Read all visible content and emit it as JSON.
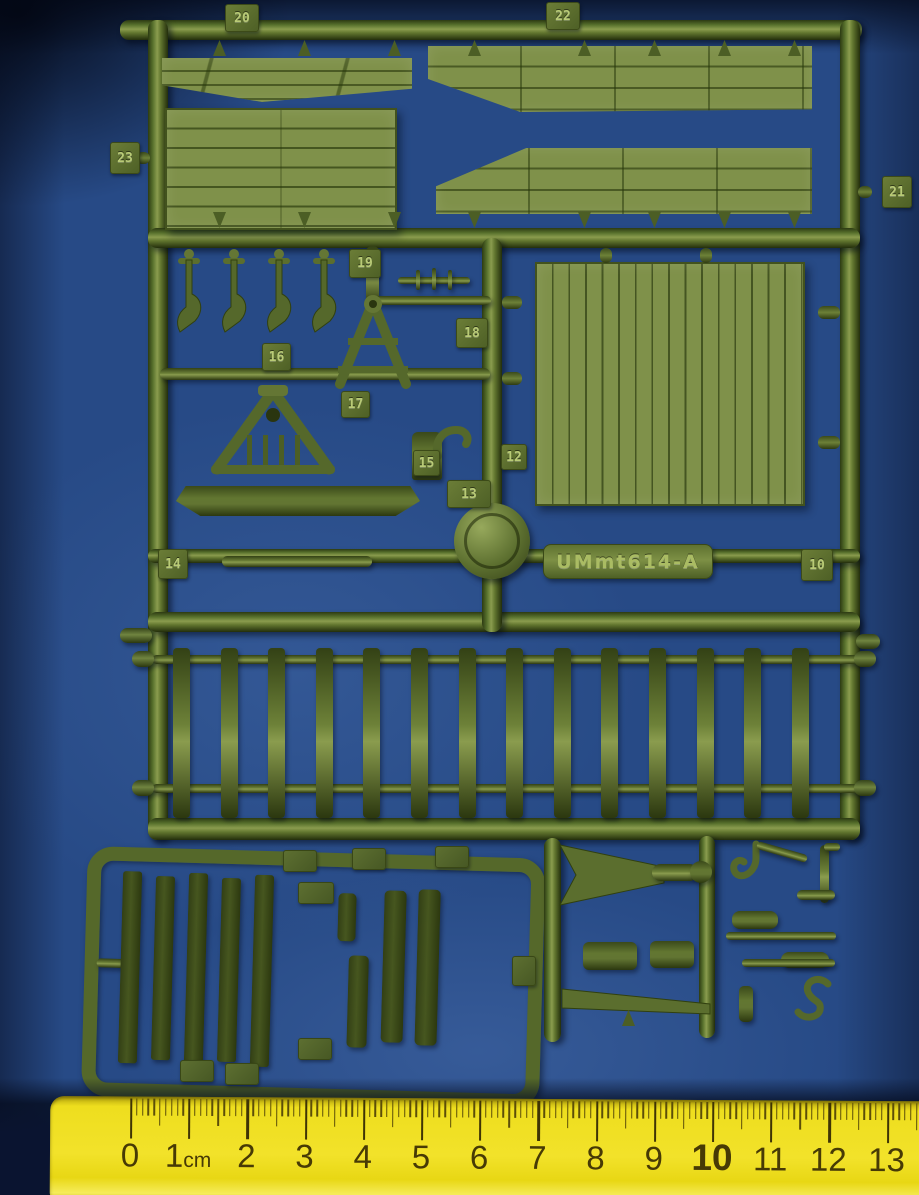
{
  "colors": {
    "background_blue": "#274a86",
    "sprue_olive": "#55682b",
    "panel_olive": "#7f914a",
    "dark_part_olive": "#3d4c1d",
    "ruler_yellow": "#eede1e",
    "ruler_markings": "#473a05"
  },
  "sprue": {
    "mold_plate": "UMmt614-A",
    "part_labels": [
      "20",
      "22",
      "23",
      "21",
      "19",
      "18",
      "16",
      "17",
      "15",
      "12",
      "13",
      "14",
      "10"
    ],
    "stakes_count": 14,
    "hooks_count": 4,
    "strips_count": 5
  },
  "ruler": {
    "unit": "cm",
    "labels": [
      "0",
      "1cm",
      "2",
      "3",
      "4",
      "5",
      "6",
      "7",
      "8",
      "9",
      "10",
      "11",
      "12",
      "13"
    ]
  }
}
